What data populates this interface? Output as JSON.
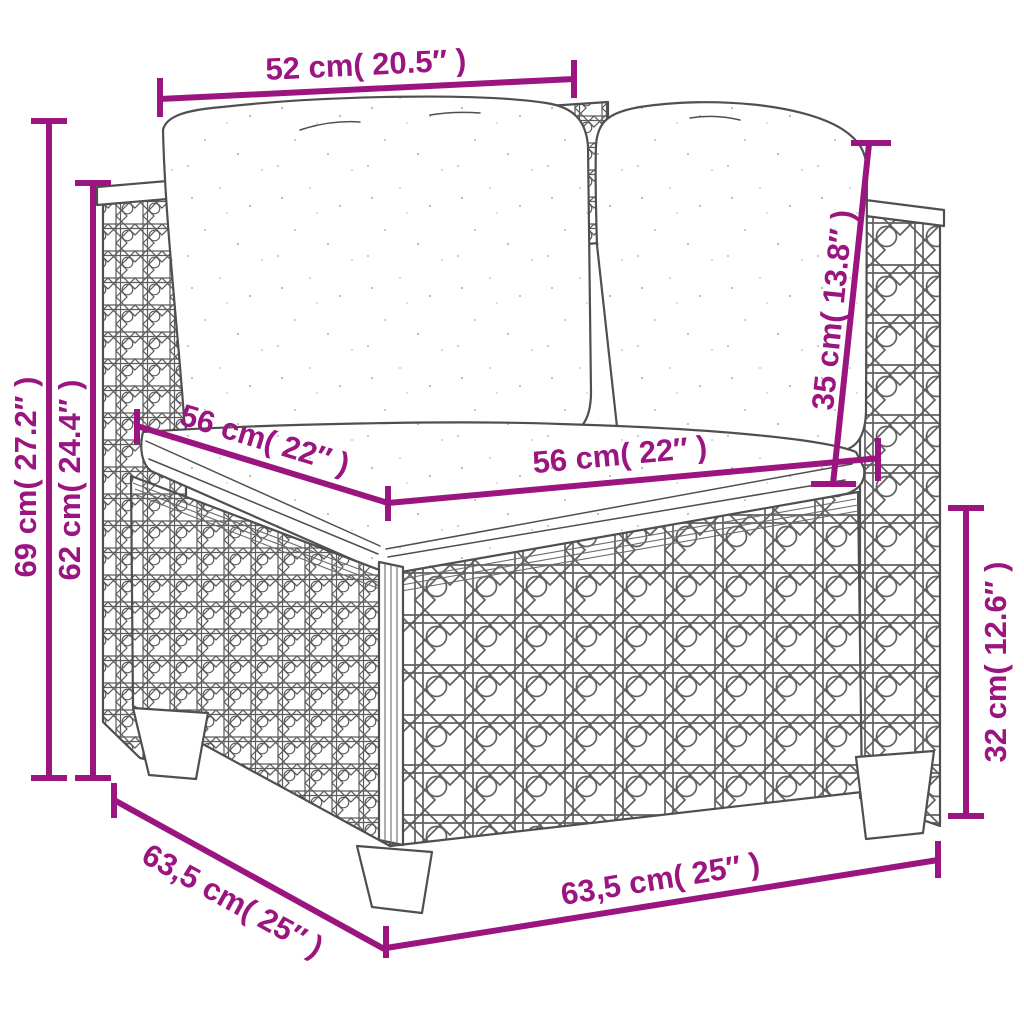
{
  "page": {
    "type": "product-dimension-diagram",
    "subject": "poly-rattan-corner-sofa-with-cushions"
  },
  "colors": {
    "dimension_annotation": "#9b1580",
    "line_art": "#4f4f4f",
    "background": "#ffffff"
  },
  "dimensions": {
    "top_back_width": {
      "text": "52 cm( 20.5″ )",
      "cm": "52",
      "inch": "20.5"
    },
    "total_height": {
      "text": "69 cm( 27.2″ )",
      "cm": "69",
      "inch": "27.2"
    },
    "arm_height": {
      "text": "62 cm( 24.4″ )",
      "cm": "62",
      "inch": "24.4"
    },
    "seat_depth": {
      "text": "56 cm( 22″ )",
      "cm": "56",
      "inch": "22"
    },
    "seat_width": {
      "text": "56 cm( 22″ )",
      "cm": "56",
      "inch": "22"
    },
    "back_cushion_height": {
      "text": "35 cm( 13.8″ )",
      "cm": "35",
      "inch": "13.8"
    },
    "base_height": {
      "text": "32 cm( 12.6″ )",
      "cm": "32",
      "inch": "12.6"
    },
    "total_depth": {
      "text": "63,5 cm( 25″ )",
      "cm": "63,5",
      "inch": "25"
    },
    "total_width": {
      "text": "63,5 cm( 25″ )",
      "cm": "63,5",
      "inch": "25"
    }
  }
}
